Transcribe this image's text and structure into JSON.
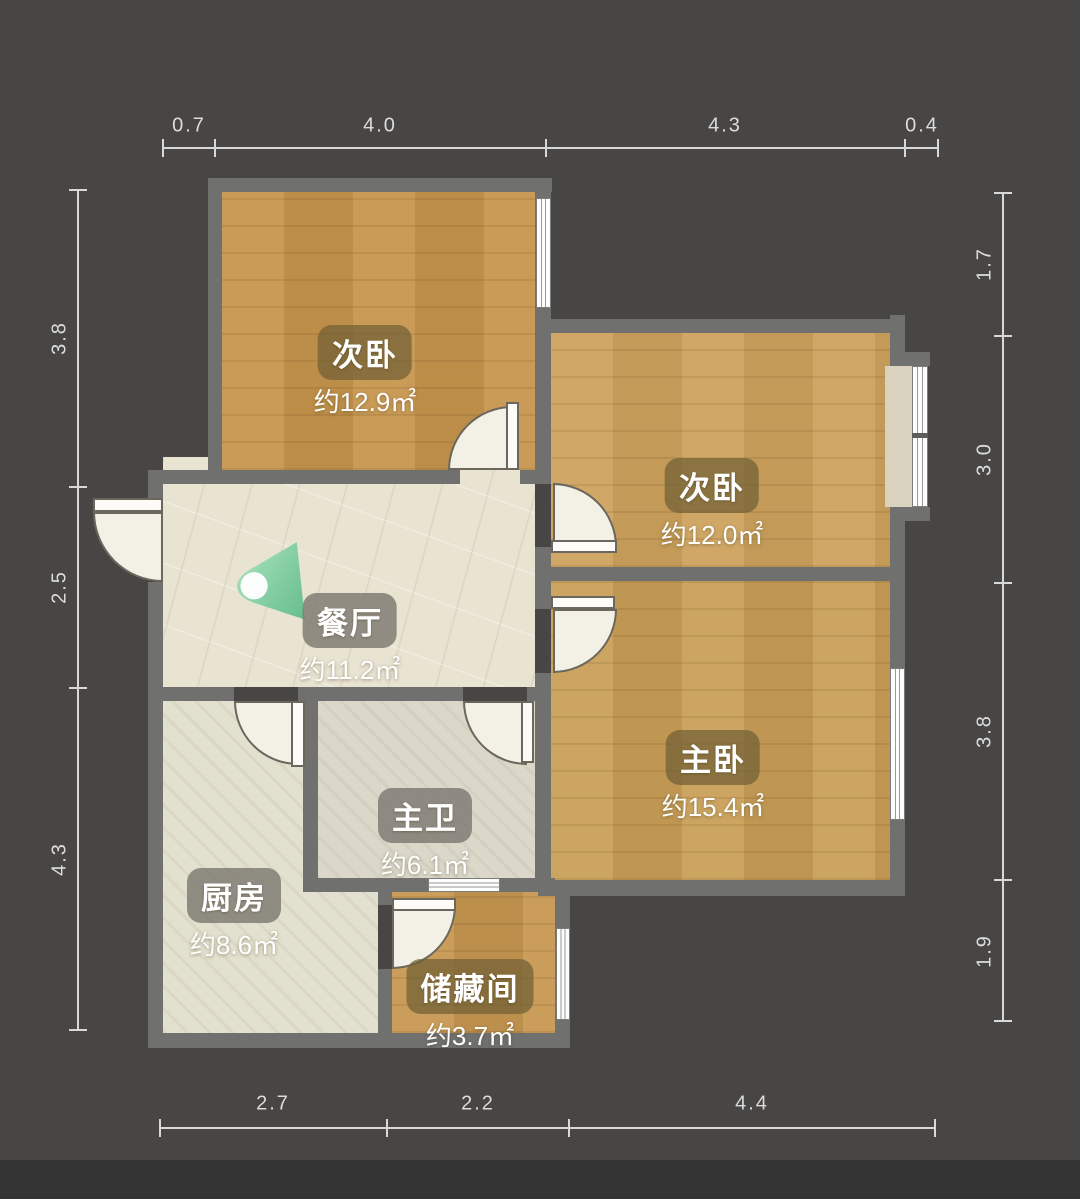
{
  "plan_title": "",
  "rooms": [
    {
      "id": "bedroom-top-left",
      "label": "次卧",
      "area": "约12.9㎡"
    },
    {
      "id": "bedroom-top-right",
      "label": "次卧",
      "area": "约12.0㎡"
    },
    {
      "id": "master-bedroom",
      "label": "主卧",
      "area": "约15.4㎡"
    },
    {
      "id": "dining-room",
      "label": "餐厅",
      "area": "约11.2㎡"
    },
    {
      "id": "master-bathroom",
      "label": "主卫",
      "area": "约6.1㎡"
    },
    {
      "id": "kitchen",
      "label": "厨房",
      "area": "约8.6㎡"
    },
    {
      "id": "storage-room",
      "label": "储藏间",
      "area": "约3.7㎡"
    }
  ],
  "dimensions": {
    "top": [
      "0.7",
      "4.0",
      "4.3",
      "0.4"
    ],
    "bottom": [
      "2.7",
      "2.2",
      "4.4"
    ],
    "left": [
      "3.8",
      "2.5",
      "4.3"
    ],
    "right": [
      "1.7",
      "3.0",
      "3.8",
      "1.9"
    ]
  },
  "icons": {
    "speaker": "audio-speaker-marker"
  },
  "colors": {
    "background": "#474645",
    "wall": "#70706e",
    "wood_floor": "#c79a52",
    "dining_floor": "#e9e3d2",
    "kitchen_floor": "#e2e0ce",
    "bath_floor": "#dbd8ca",
    "dimension_text": "#dcdcdc",
    "speaker_green": "#6cc493"
  }
}
